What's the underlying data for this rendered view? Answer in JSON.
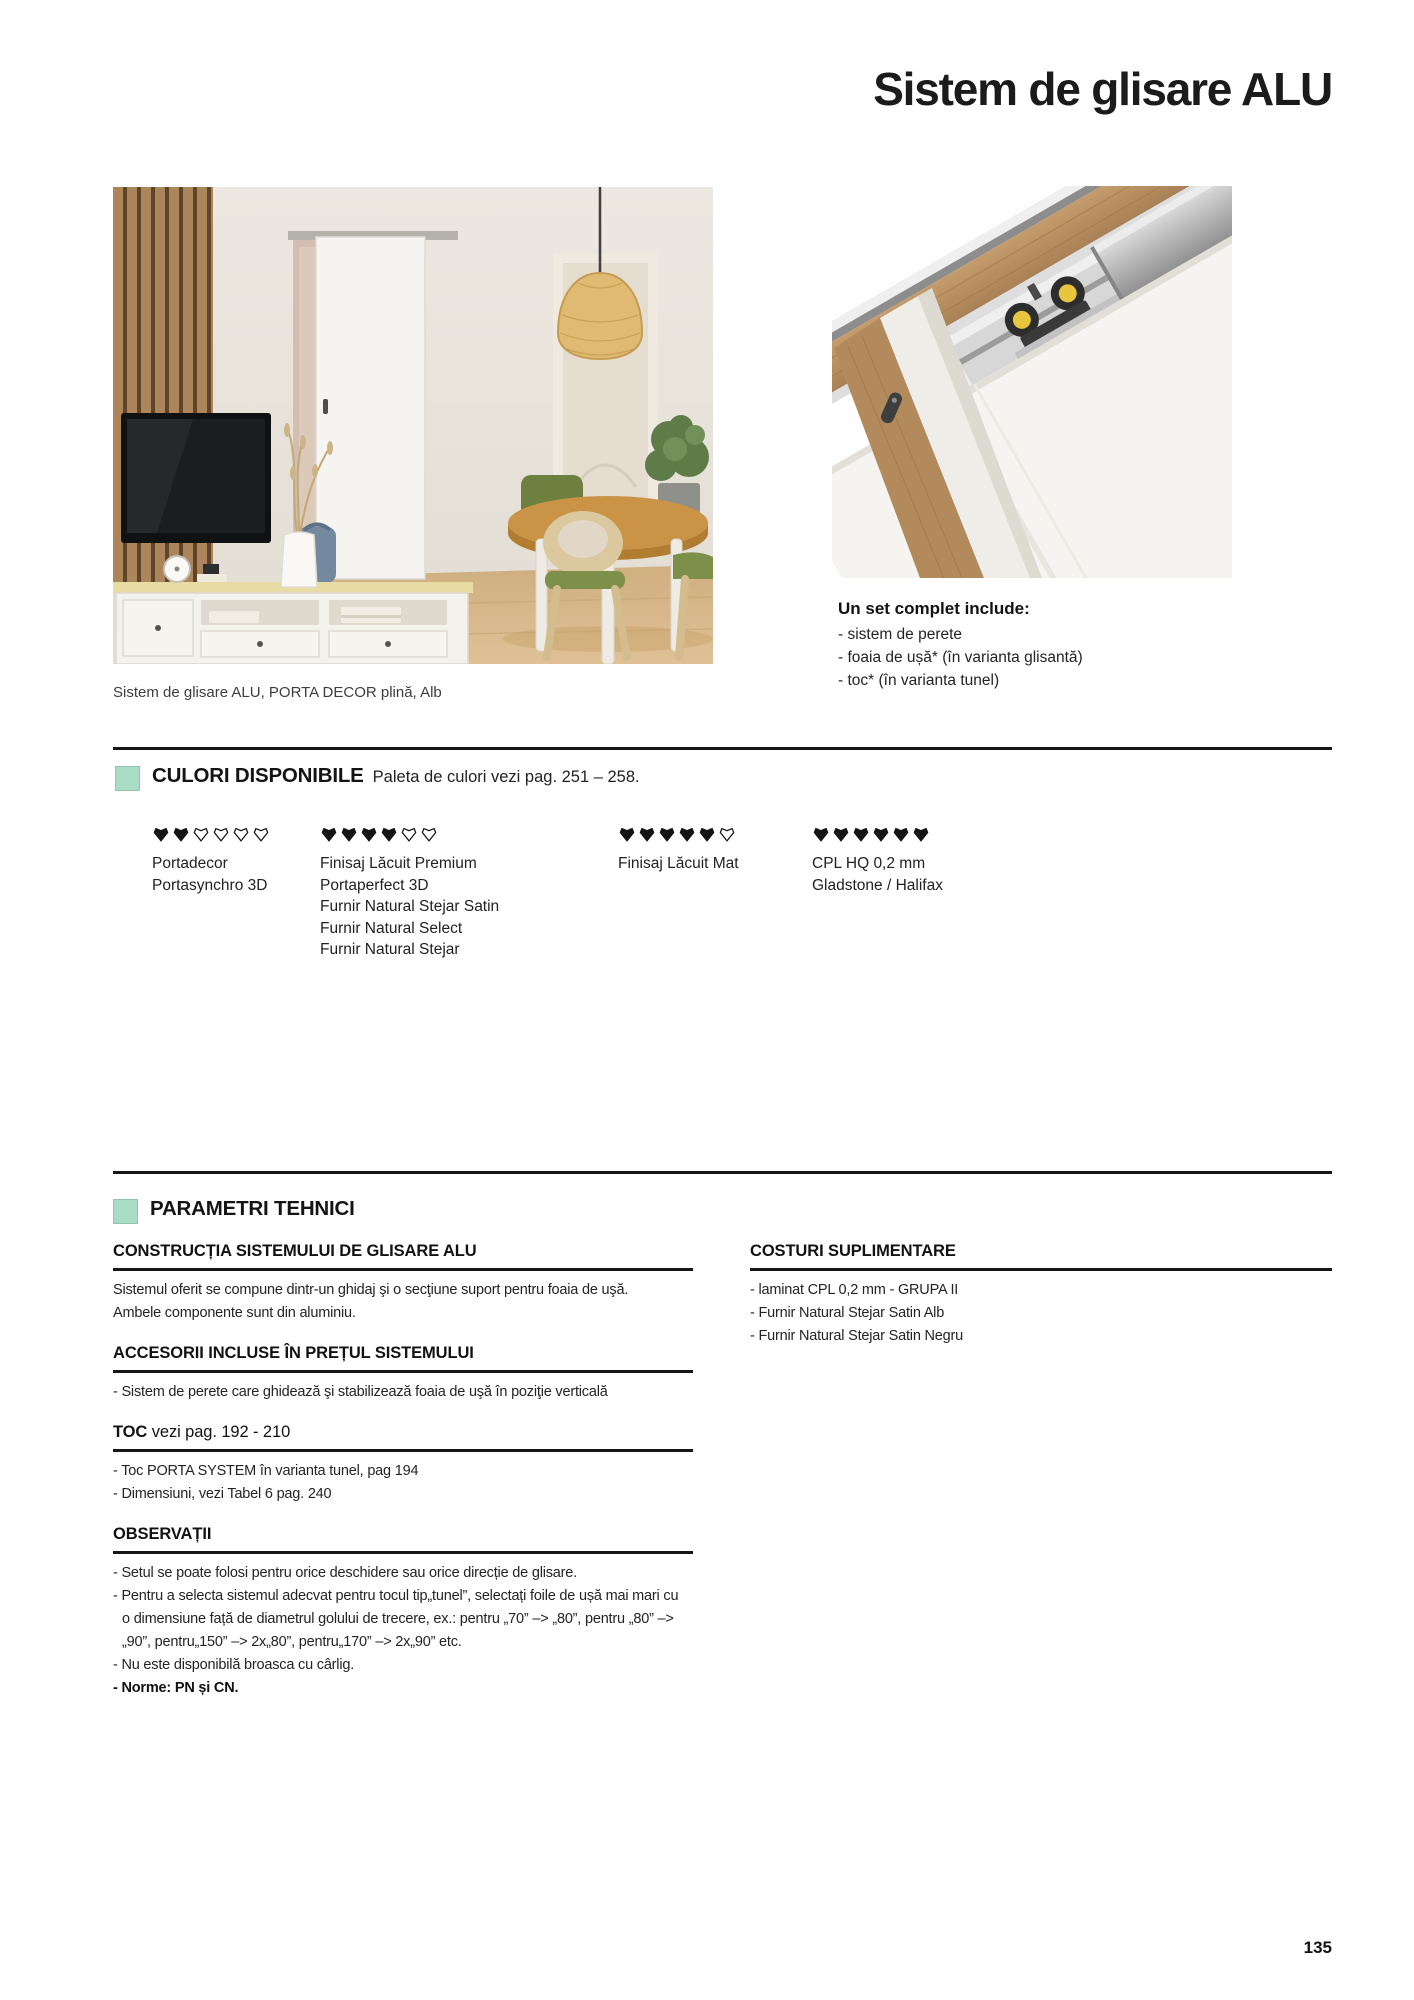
{
  "page": {
    "title": "Sistem de glisare ALU",
    "page_number": "135"
  },
  "palette": {
    "accent_green": "#a9dcc4",
    "text": "#1a1a1a",
    "divider": "#161616",
    "diamond_fill": "#141414"
  },
  "icons": {
    "section_marker": "green-square",
    "durability_rating": "diamond-glyph (filled = rating, outline = remainder)"
  },
  "hero": {
    "caption": "Sistem de glisare ALU, PORTA DECOR plină, Alb",
    "set_include": {
      "heading": "Un set complet include:",
      "items": [
        "- sistem de perete",
        "- foaia de ușă* (în varianta glisantă)",
        "- toc* (în varianta tunel)"
      ]
    }
  },
  "colors_section": {
    "heading": "CULORI DISPONIBILE",
    "subheading": "Paleta de culori vezi pag. 251 –  258.",
    "columns": [
      {
        "filled": 2,
        "total": 6,
        "lines": [
          "Portadecor",
          "Portasynchro 3D"
        ]
      },
      {
        "filled": 4,
        "total": 6,
        "lines": [
          "Finisaj Lăcuit Premium",
          "Portaperfect 3D",
          "Furnir Natural Stejar Satin",
          "Furnir Natural Select",
          "Furnir Natural Stejar"
        ]
      },
      {
        "filled": 5,
        "total": 6,
        "lines": [
          "Finisaj Lăcuit Mat"
        ]
      },
      {
        "filled": 6,
        "total": 6,
        "lines": [
          "CPL HQ 0,2 mm",
          "Gladstone / Halifax"
        ]
      }
    ]
  },
  "tech": {
    "heading": "PARAMETRI TEHNICI",
    "construction": {
      "title": "CONSTRUCȚIA SISTEMULUI DE GLISARE ALU",
      "lines": [
        "Sistemul oferit se compune dintr-un ghidaj şi o secţiune suport pentru foaia de uşă.",
        "Ambele componente sunt din aluminiu."
      ]
    },
    "accessories": {
      "title": "ACCESORII INCLUSE ÎN PREȚUL SISTEMULUI",
      "lines": [
        "- Sistem de perete care ghidează şi stabilizează foaia de uşă în poziţie verticală"
      ]
    },
    "toc": {
      "title": "TOC",
      "title_suffix": " vezi pag. 192 - 210",
      "lines": [
        "- Toc PORTA SYSTEM în varianta tunel, pag 194",
        "- Dimensiuni, vezi Tabel 6 pag. 240"
      ]
    },
    "observations": {
      "title": "OBSERVAȚII",
      "lines": [
        "- Setul se poate folosi pentru orice deschidere sau orice direcție de glisare.",
        "- Pentru a selecta sistemul adecvat pentru tocul tip„tunel”, selectați foile de ușă mai mari cu",
        "o dimensiune față de diametrul golului de trecere, ex.: pentru „70” –> „80”, pentru „80” –>",
        "„90”, pentru„150” –> 2x„80”, pentru„170” –> 2x„90” etc.",
        "- Nu este disponibilă broasca cu cârlig.",
        "- Norme: PN și CN."
      ]
    },
    "extra_costs": {
      "title": "COSTURI SUPLIMENTARE",
      "lines": [
        "- laminat CPL 0,2 mm - GRUPA II",
        "- Furnir Natural Stejar Satin Alb",
        "- Furnir Natural Stejar Satin Negru"
      ]
    }
  }
}
